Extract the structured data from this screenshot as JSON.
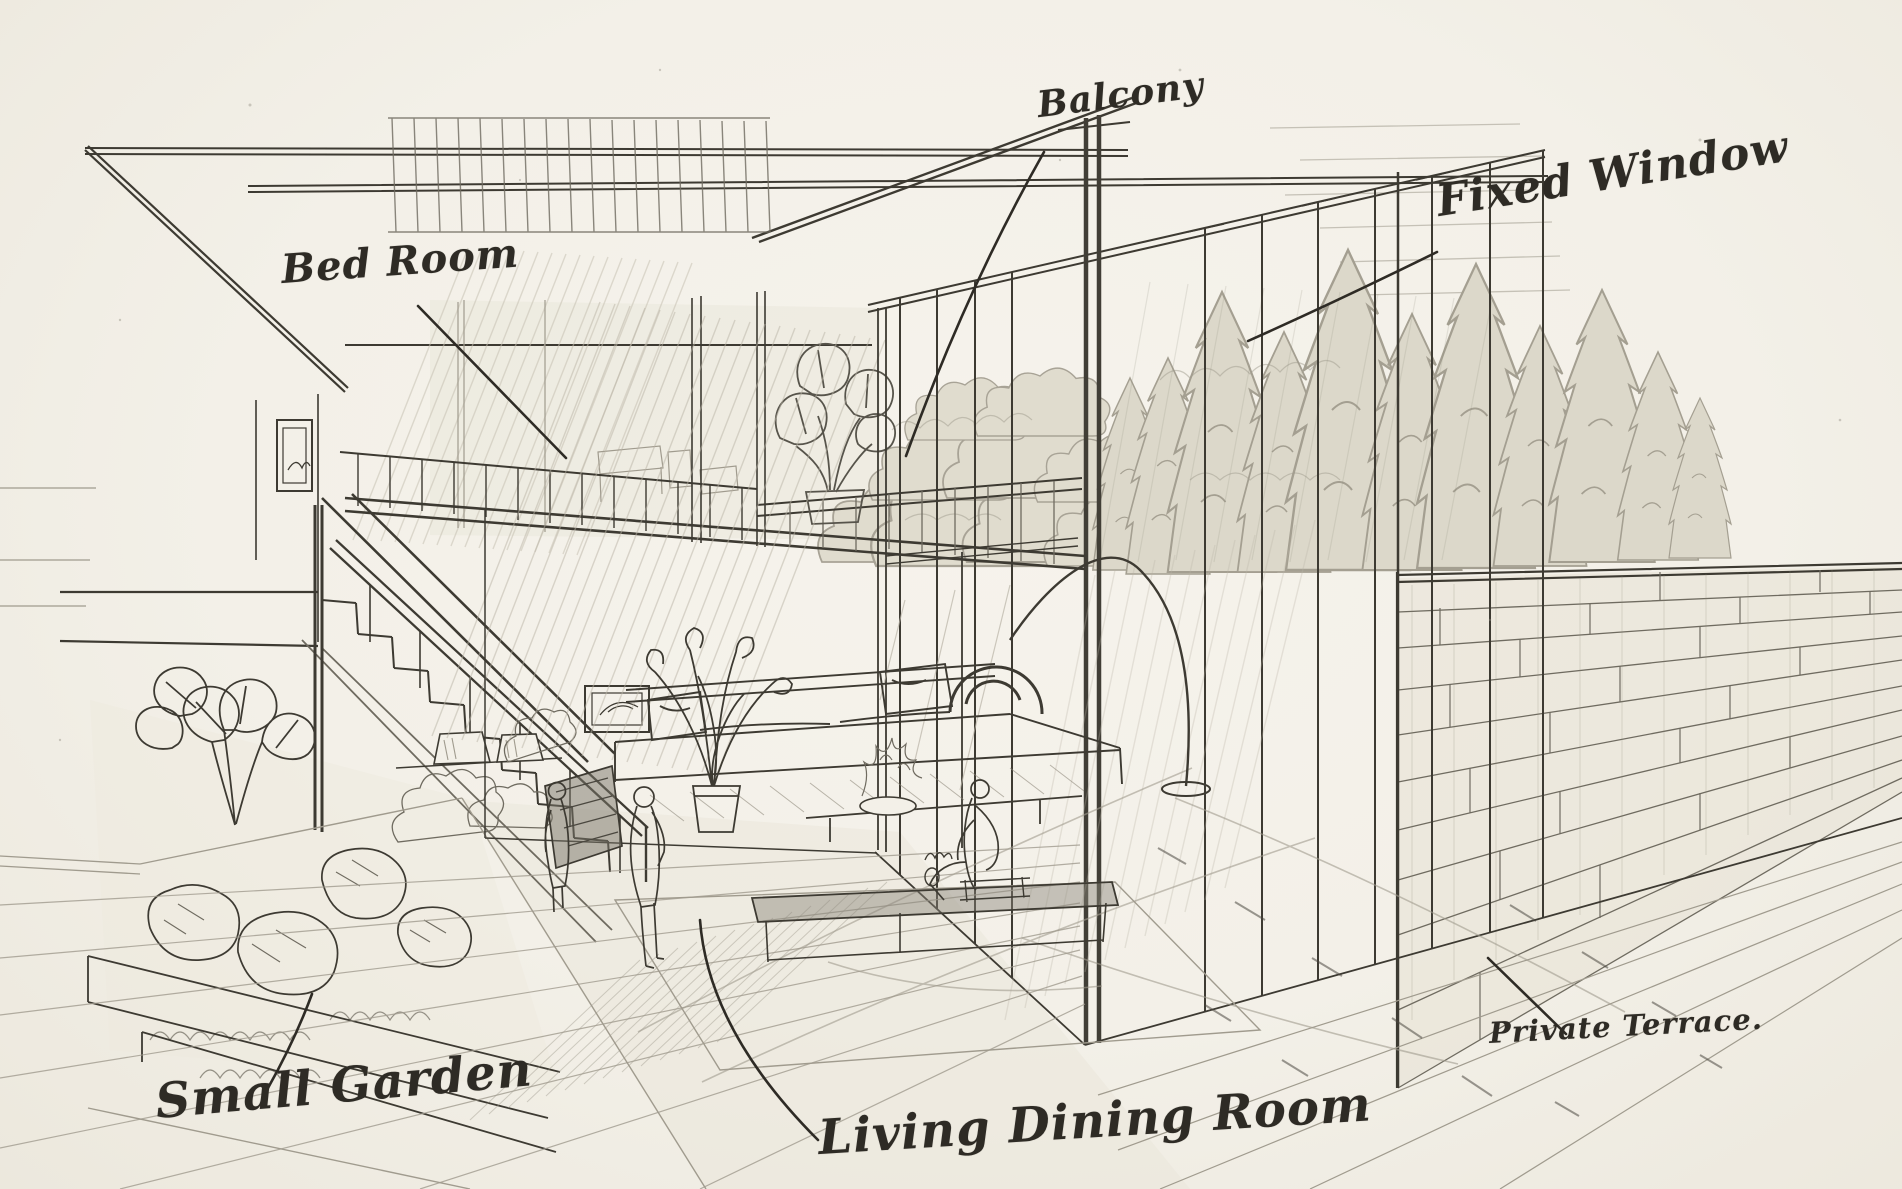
{
  "annotations": {
    "bed_room": {
      "label": "Bed Room"
    },
    "balcony": {
      "label": "Balcony"
    },
    "fixed_window": {
      "label": "Fixed Window"
    },
    "small_garden": {
      "label": "Small Garden"
    },
    "living_dining_room": {
      "label": "Living Dining Room"
    },
    "private_terrace": {
      "label": "Private Terrace."
    }
  },
  "palette": {
    "paper": "#f3f0e8",
    "graphite_dark": "#3d3a32",
    "graphite_mid": "#6f6b60",
    "graphite_soft": "#a09b8e"
  }
}
